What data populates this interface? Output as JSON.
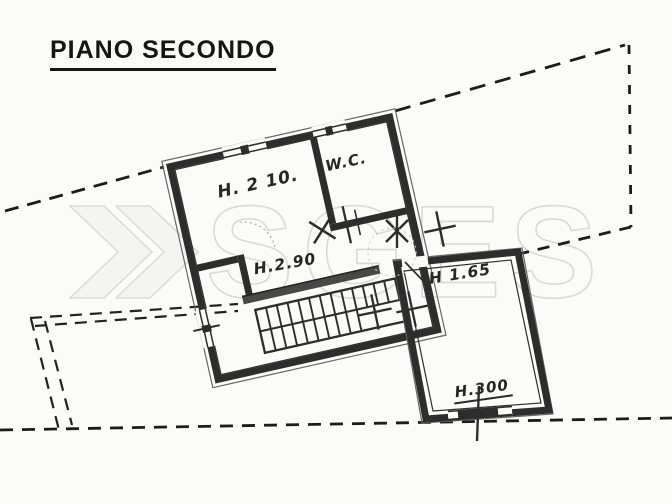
{
  "title": "PIANO SECONDO",
  "watermark": {
    "text": "SGES"
  },
  "rooms": {
    "room_h210": "H. 2 10.",
    "room_wc": "W.C.",
    "room_h290": "H.2.90",
    "room_h165": "H 1.65",
    "room_h300": "H.300"
  },
  "colors": {
    "paper": "#fbfbf9",
    "wall_ink": "#2d2d2d",
    "thick_wall_gray": "#484848",
    "boundary_ink": "#1c1c1c",
    "watermark_gray": "#d9d9d9",
    "title_ink": "#151515"
  }
}
